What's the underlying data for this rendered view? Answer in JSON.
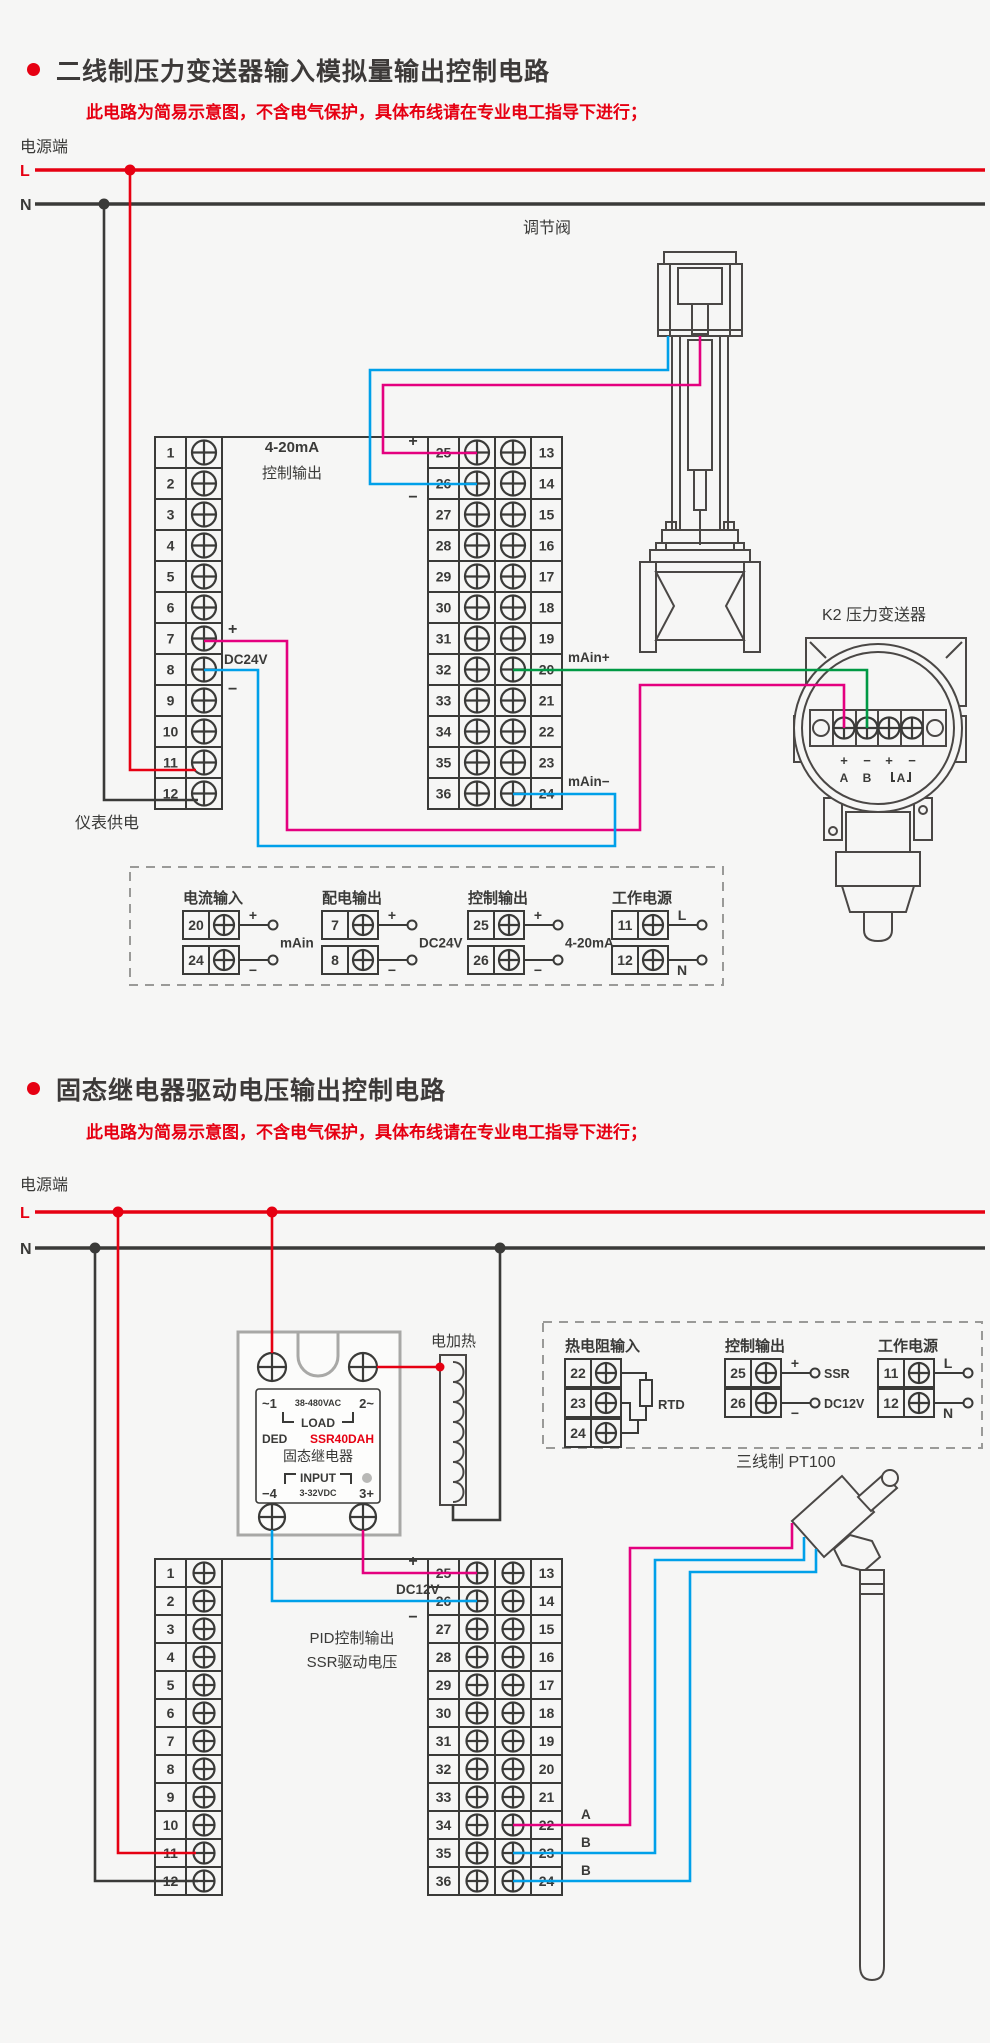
{
  "sym": {
    "plus": "+",
    "minus": "−"
  },
  "section1": {
    "title": "二线制压力变送器输入模拟量输出控制电路",
    "subtitle": "此电路为简易示意图，不含电气保护，具体布线请在专业电工指导下进行；",
    "power_label": "电源端",
    "l_label": "L",
    "n_label": "N",
    "left_block": {
      "numbers": [
        "1",
        "2",
        "3",
        "4",
        "5",
        "6",
        "7",
        "8",
        "9",
        "10",
        "11",
        "12"
      ],
      "dc_label": "DC24V",
      "bottom_label": "仪表供电"
    },
    "center_caption_line1": "4-20mA",
    "center_caption_line2": "控制输出",
    "center_block": {
      "left_numbers": [
        "25",
        "26",
        "27",
        "28",
        "29",
        "30",
        "31",
        "32",
        "33",
        "34",
        "35",
        "36"
      ],
      "right_numbers": [
        "13",
        "14",
        "15",
        "16",
        "17",
        "18",
        "19",
        "20",
        "21",
        "22",
        "23",
        "24"
      ],
      "main_plus": "mAin+",
      "main_minus": "mAin−"
    },
    "valve_label": "调节阀",
    "transmitter": {
      "label": "K2 压力变送器",
      "signs": [
        "+",
        "−",
        "+",
        "−"
      ],
      "letters": [
        "A",
        "B",
        "A"
      ]
    },
    "legend": {
      "groups": [
        {
          "title": "电流输入",
          "rows": [
            {
              "num": "20",
              "sign": "+"
            },
            {
              "num": "24",
              "sign": "−"
            }
          ],
          "label": "mAin"
        },
        {
          "title": "配电输出",
          "rows": [
            {
              "num": "7",
              "sign": "+"
            },
            {
              "num": "8",
              "sign": "−"
            }
          ],
          "label": "DC24V"
        },
        {
          "title": "控制输出",
          "rows": [
            {
              "num": "25",
              "sign": "+"
            },
            {
              "num": "26",
              "sign": "−"
            }
          ],
          "label": "4-20mA"
        },
        {
          "title": "工作电源",
          "rows": [
            {
              "num": "11",
              "sign": "L"
            },
            {
              "num": "12",
              "sign": "N"
            }
          ]
        }
      ]
    }
  },
  "section2": {
    "title": "固态继电器驱动电压输出控制电路",
    "subtitle": "此电路为简易示意图，不含电气保护，具体布线请在专业电工指导下进行；",
    "power_label": "电源端",
    "l_label": "L",
    "n_label": "N",
    "ssr": {
      "t1": "~1",
      "vac": "38-480VAC",
      "t2": "2~",
      "load": "LOAD",
      "brand": "DED",
      "model": "SSR40DAH",
      "name": "固态继电器",
      "input": "INPUT",
      "t4": "−4",
      "vdc": "3-32VDC",
      "t3": "3+"
    },
    "heater_label": "电加热",
    "legend": {
      "groups": [
        {
          "title": "热电阻输入",
          "rows": [
            {
              "num": "22"
            },
            {
              "num": "23"
            },
            {
              "num": "24"
            }
          ],
          "label": "RTD"
        },
        {
          "title": "控制输出",
          "rows": [
            {
              "num": "25",
              "sign": "+",
              "label": "SSR"
            },
            {
              "num": "26",
              "sign": "−",
              "label": "DC12V"
            }
          ]
        },
        {
          "title": "工作电源",
          "rows": [
            {
              "num": "11",
              "sign": "L"
            },
            {
              "num": "12",
              "sign": "N"
            }
          ]
        }
      ]
    },
    "left_block": {
      "numbers": [
        "1",
        "2",
        "3",
        "4",
        "5",
        "6",
        "7",
        "8",
        "9",
        "10",
        "11",
        "12"
      ]
    },
    "center_block": {
      "left_numbers": [
        "25",
        "26",
        "27",
        "28",
        "29",
        "30",
        "31",
        "32",
        "33",
        "34",
        "35",
        "36"
      ],
      "right_numbers": [
        "13",
        "14",
        "15",
        "16",
        "17",
        "18",
        "19",
        "20",
        "21",
        "22",
        "23",
        "24"
      ],
      "dc_label": "DC12V",
      "pid_line1": "PID控制输出",
      "pid_line2": "SSR驱动电压",
      "a_label": "A",
      "b1_label": "B",
      "b2_label": "B"
    },
    "pt100_label": "三线制 PT100"
  }
}
